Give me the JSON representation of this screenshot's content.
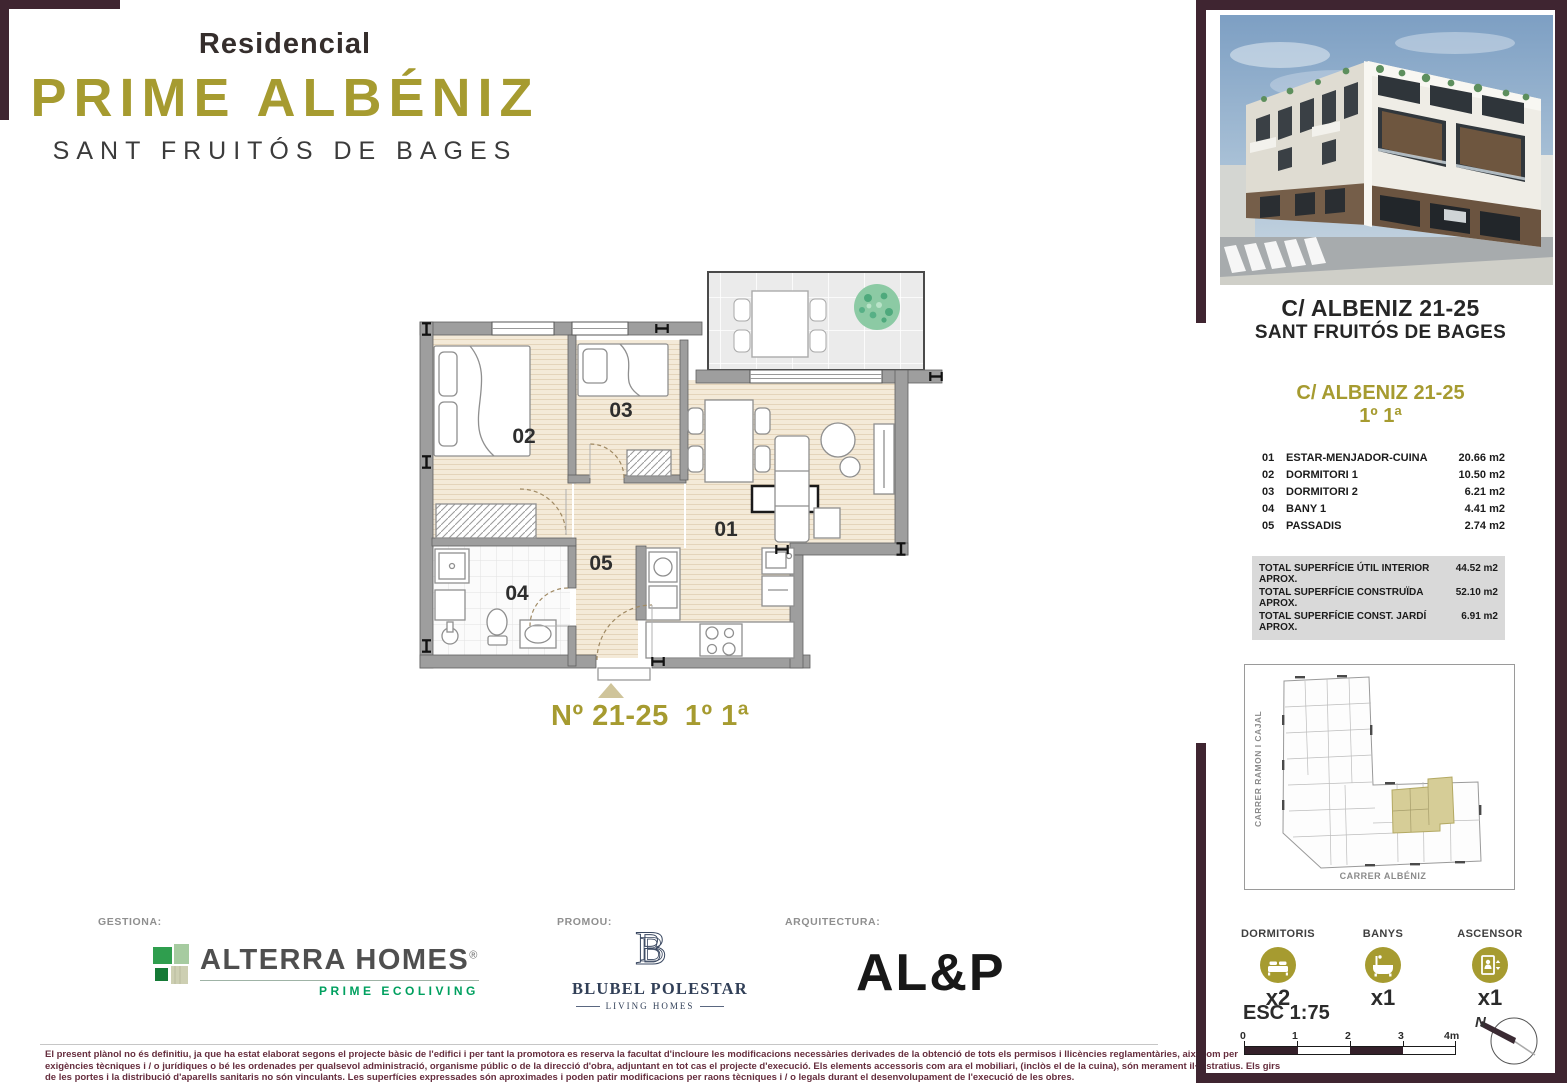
{
  "brand": {
    "prefix": "Residencial",
    "name": "PRIME ALBÉNIZ",
    "location": "SANT FRUITÓS DE BAGES"
  },
  "plan": {
    "labels": {
      "living": "01",
      "dormitori1": "02",
      "dormitori2": "03",
      "bany": "04",
      "passadis": "05"
    },
    "caption": {
      "number": "Nº 21-25",
      "floor": "1º 1ª"
    }
  },
  "sidebar": {
    "address": {
      "line1": "C/ ALBENIZ 21-25",
      "line2": "SANT FRUITÓS DE BAGES"
    },
    "unit": {
      "title": "C/ ALBENIZ 21-25",
      "floor": "1º 1ª"
    },
    "rooms": [
      {
        "num": "01",
        "name": "ESTAR-MENJADOR-CUINA",
        "area": "20.66 m2"
      },
      {
        "num": "02",
        "name": "DORMITORI 1",
        "area": "10.50 m2"
      },
      {
        "num": "03",
        "name": "DORMITORI 2",
        "area": "6.21 m2"
      },
      {
        "num": "04",
        "name": "BANY 1",
        "area": "4.41 m2"
      },
      {
        "num": "05",
        "name": "PASSADIS",
        "area": "2.74 m2"
      }
    ],
    "totals": [
      {
        "label": "TOTAL SUPERFÍCIE ÚTIL INTERIOR APROX.",
        "value": "44.52 m2"
      },
      {
        "label": "TOTAL SUPERFÍCIE CONSTRUÏDA APROX.",
        "value": "52.10 m2"
      },
      {
        "label": "TOTAL SUPERFÍCIE CONST. JARDÍ APROX.",
        "value": "6.91 m2"
      }
    ],
    "siteplan": {
      "street_left": "CARRER RAMON I CAJAL",
      "street_bottom": "CARRER ALBÉNIZ"
    },
    "features": [
      {
        "label": "DORMITORIS",
        "count": "x2"
      },
      {
        "label": "BANYS",
        "count": "x1"
      },
      {
        "label": "ASCENSOR",
        "count": "x1"
      }
    ],
    "scale": {
      "label": "ESC 1:75",
      "ticks": [
        "0",
        "1",
        "2",
        "3"
      ],
      "end_label": "4m"
    },
    "north_label": "N"
  },
  "footer": {
    "gestiona_label": "GESTIONA:",
    "promou_label": "PROMOU:",
    "arquitectura_label": "ARQUITECTURA:",
    "alterra": {
      "name": "ALTERRA HOMES",
      "registered": "®",
      "tagline": "PRIME ECOLIVING"
    },
    "blubel": {
      "monogram": "B",
      "name": "BLUBEL POLESTAR",
      "tagline": "LIVING HOMES"
    },
    "architecture_name": "AL&P"
  },
  "disclaimer": {
    "lines": [
      "El present plànol no és definitiu, ja que ha estat elaborat segons el projecte bàsic de l'edifici i per tant la promotora es reserva la facultat d'incloure les modificacions necessàries derivades de la obtenció de tots els permisos i llicències reglamentàries, així com per",
      "exigències tècniques i / o jurídiques o bé les ordenades per qualsevol administració, organisme públic o de la direcció d'obra, adjuntant en tot cas el projecte d'execució. Els elements accessoris com ara el mobiliari, (inclòs el de la cuina), són merament il·lustratius. Els girs",
      "de les portes i la distribució d'aparells sanitaris no són vinculants. Les superfícies expressades són aproximades i poden patir modificacions per raons tècniques i / o legals durant el desenvolupament de l'execució de les obres."
    ]
  },
  "colors": {
    "gold": "#a69b30",
    "maroon": "#3f2531",
    "alterra_green": "#00a05f",
    "blubel_navy": "#313f57",
    "unit_highlight": "#d6cd97"
  }
}
